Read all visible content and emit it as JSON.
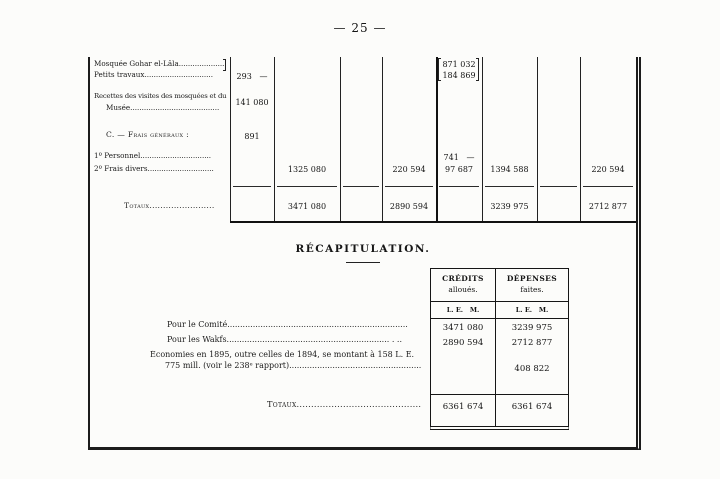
{
  "page": {
    "number_display": "— 25 —"
  },
  "ledger": {
    "rows": {
      "mosquee": {
        "label": "Mosquée Gohar el-Lâla.......................",
        "c5": "871 032"
      },
      "petits_travaux": {
        "label": "Petits travaux..............................",
        "c1": "293   —",
        "c5": "184 869"
      },
      "recettes": {
        "label_line1": "Recettes des visites des mosquées et du",
        "label_line2": "Musée.......................................",
        "c1": "141 080"
      },
      "frais_generaux": {
        "label": "C. — Frais généraux :",
        "c1": "891"
      },
      "personnel": {
        "label": "1º Personnel...............................",
        "c5": "741   —"
      },
      "frais_divers": {
        "label": "2º Frais divers.............................",
        "c2": "1325 080",
        "c4": "220 594",
        "c5": "97 687",
        "c6": "1394 588",
        "c8": "220 594"
      },
      "totaux": {
        "label": "Totaux........................",
        "c2": "3471 080",
        "c4": "2890 594",
        "c6": "3239 975",
        "c8": "2712 877"
      }
    }
  },
  "recap": {
    "title": "RÉCAPITULATION.",
    "header": {
      "col1_title": "CRÉDITS",
      "col1_sub": "alloués.",
      "col2_title": "DÉPENSES",
      "col2_sub": "faites.",
      "units": "L. E.   M."
    },
    "rows": {
      "comite": {
        "label": "Pour le Comité.......................................................................",
        "credits": "3471 080",
        "depenses": "3239 975"
      },
      "wakfs": {
        "label": "Pour les Wakfs................................................................  .  ..",
        "credits": "2890 594",
        "depenses": "2712 877"
      },
      "economies": {
        "label_line1": "Économies en 1895, outre celles de 1894, se montant à 158 L. E.",
        "label_line2": "775 mill. (voir le 238ᵉ rapport)....................................................",
        "depenses": "408 822"
      },
      "totaux": {
        "label": "Totaux...........................................",
        "credits": "6361 674",
        "depenses": "6361 674"
      }
    }
  }
}
